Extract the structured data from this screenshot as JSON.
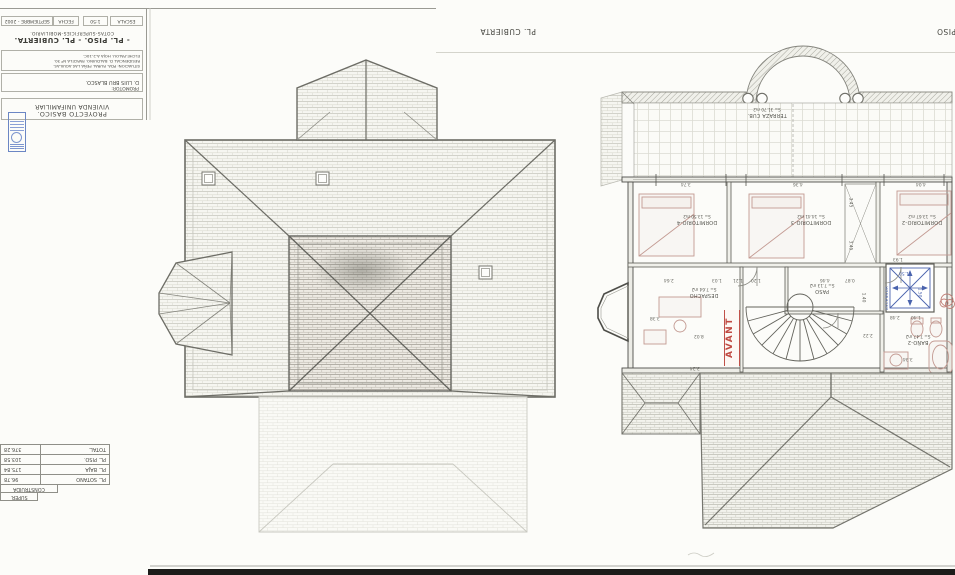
{
  "sheet": {
    "escala_label": "ESCALA",
    "escala_value": "1:50",
    "fecha_label": "FECHA",
    "fecha_value": "SEPTIEMBRE - 2002",
    "title": "- PL. PISO. - PL. CUBIERTA.",
    "subtitle": "COTAS-SUPERFICIES-MOBILIARIO.",
    "situacion": [
      "SITUACION: PDA. RURAL PEÑA LAS AGUILAS.",
      "RESIDENCIAL D. BALDUINO. PARCELA Nº 30.",
      "ELCHE-PALOU. HOJA A-2-10C."
    ],
    "promotor_label": "PROMOTOR:",
    "promotor_name": "D. LUIS BRU BLASCO.",
    "proyecto_line1": "PROYECTO BASICO.",
    "proyecto_line2": "VIVIENDA UNIFAMILIAR"
  },
  "plan_titles": {
    "cubierta": "PL. CUBIERTA",
    "piso": "PL. PISO"
  },
  "surface_table": {
    "header_line1": "SUPER.",
    "header_line2": "CONSTRUIDA",
    "rows": [
      {
        "label": "PL. SOTANO",
        "value": "96.78"
      },
      {
        "label": "PL. BAJA",
        "value": "175.84"
      },
      {
        "label": "PL. PISO.",
        "value": "103.58"
      },
      {
        "label": "TOTAL.",
        "value": "376.28"
      }
    ]
  },
  "floor_plan": {
    "stamp": "AVANT",
    "elevator_label": "ASCENSOR",
    "rooms": [
      {
        "name": "TERRAZA CUB.",
        "area": "S= 31.70 m2",
        "x": 737,
        "y": 107,
        "w": 60
      },
      {
        "name": "DORMITORIO-4",
        "area": "S= 13.50 m2",
        "x": 666,
        "y": 214,
        "w": 62
      },
      {
        "name": "DORMITORIO-3",
        "area": "S= 14.41 m2",
        "x": 780,
        "y": 214,
        "w": 62
      },
      {
        "name": "DORMITORIO-2",
        "area": "S= 13.67 m2",
        "x": 891,
        "y": 214,
        "w": 62
      },
      {
        "name": "DESPACHO",
        "area": "S= 7.64 m2",
        "x": 676,
        "y": 287,
        "w": 56
      },
      {
        "name": "PASO",
        "area": "S= 7.13 m2",
        "x": 800,
        "y": 283,
        "w": 44
      },
      {
        "name": "BAÑO-2",
        "area": "S= 7.47 m2",
        "x": 894,
        "y": 334,
        "w": 48
      }
    ],
    "dimensions": [
      {
        "t": "3.74",
        "x": 681,
        "y": 181
      },
      {
        "t": "4.36",
        "x": 793,
        "y": 181
      },
      {
        "t": "4.04",
        "x": 916,
        "y": 181
      },
      {
        "t": "3.45",
        "x": 845,
        "y": 200,
        "v": 1
      },
      {
        "t": "3.45",
        "x": 845,
        "y": 243,
        "v": 1
      },
      {
        "t": "2.64",
        "x": 664,
        "y": 277
      },
      {
        "t": "1.03",
        "x": 712,
        "y": 277
      },
      {
        "t": "1.21",
        "x": 733,
        "y": 277
      },
      {
        "t": "1.20",
        "x": 751,
        "y": 277
      },
      {
        "t": "4.46",
        "x": 820,
        "y": 277
      },
      {
        "t": "0.87",
        "x": 845,
        "y": 277
      },
      {
        "t": "1.93",
        "x": 893,
        "y": 256
      },
      {
        "t": "1.50",
        "x": 899,
        "y": 270,
        "c": 1
      },
      {
        "t": "1.50",
        "x": 914,
        "y": 290,
        "c": 1,
        "v": 1
      },
      {
        "t": "1.40",
        "x": 858,
        "y": 295,
        "v": 1
      },
      {
        "t": "3.38",
        "x": 650,
        "y": 315
      },
      {
        "t": "8.02",
        "x": 694,
        "y": 333
      },
      {
        "t": "2.22",
        "x": 863,
        "y": 332
      },
      {
        "t": "2.48",
        "x": 890,
        "y": 314
      },
      {
        "t": "1.40",
        "x": 911,
        "y": 314
      },
      {
        "t": "3.24",
        "x": 690,
        "y": 365
      },
      {
        "t": "3.34",
        "x": 903,
        "y": 356
      }
    ]
  }
}
